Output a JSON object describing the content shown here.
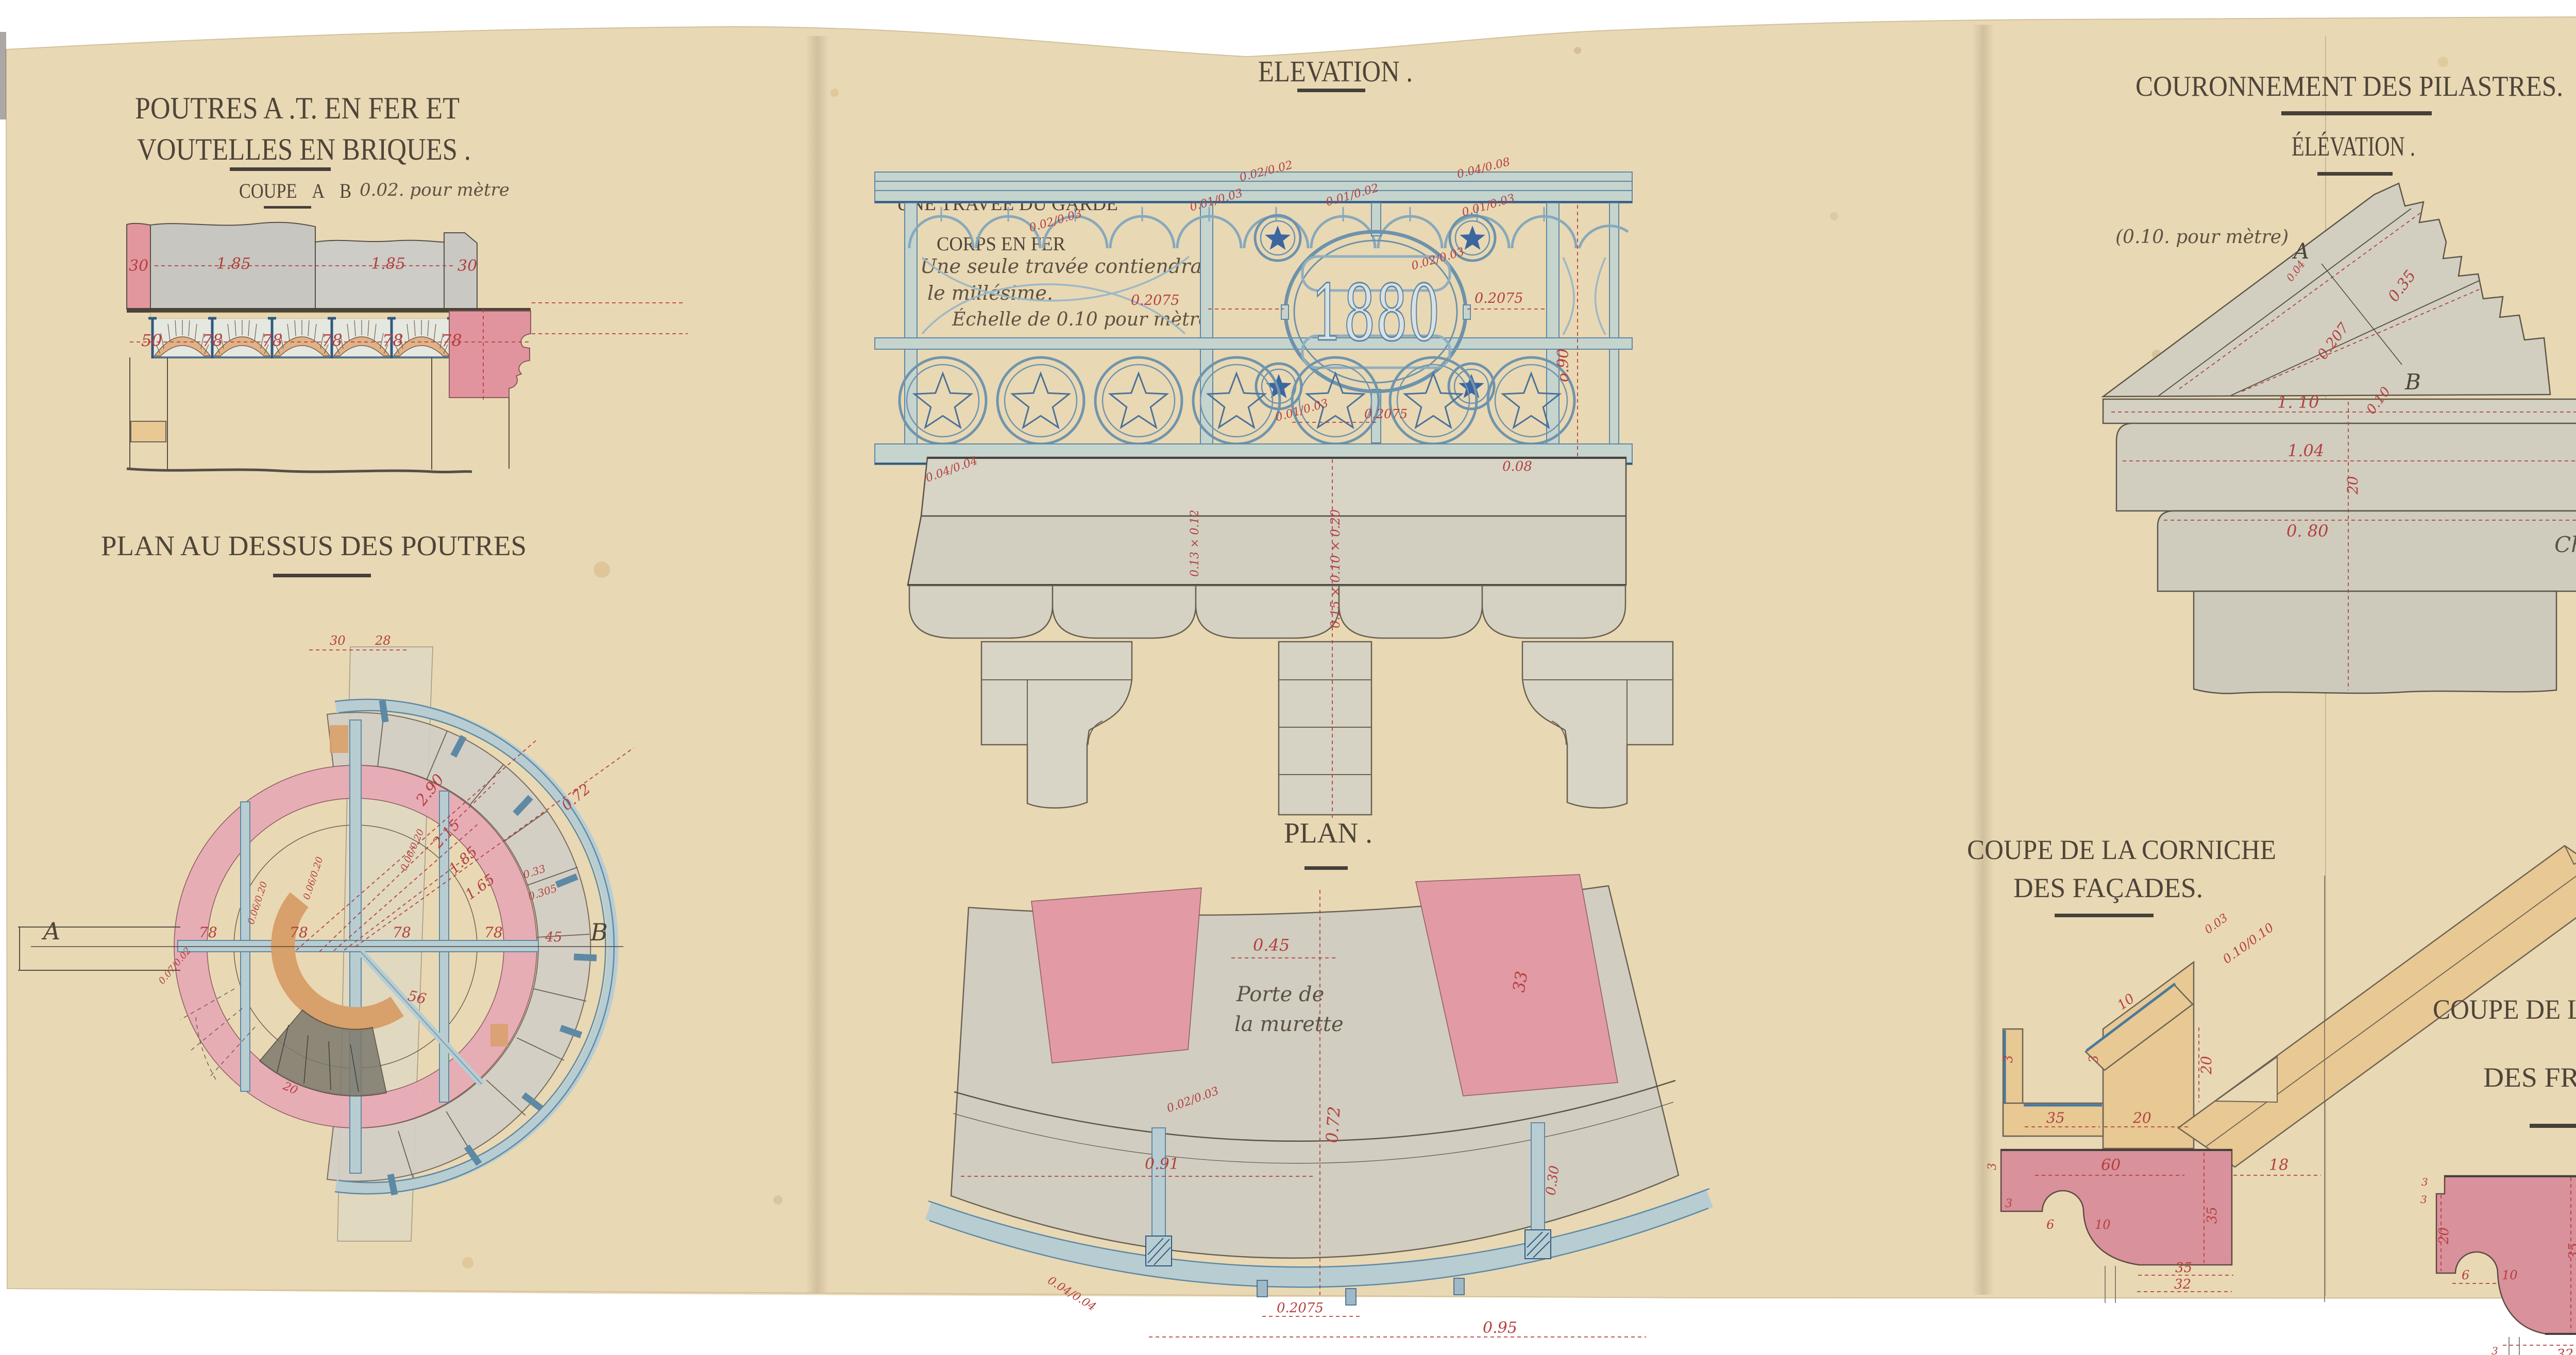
{
  "colors": {
    "paper": "#e9d8b4",
    "white_margin": "#ffffff",
    "ink": "#4e4539",
    "dimension_red": "#b4403f",
    "iron_blue": "#5e89a4",
    "iron_blue_fill": "#c6d4ce",
    "stone_grey": "#d1cec0",
    "wash_pink": "#d9919b",
    "ring_pink": "#e7abb5",
    "wood_yellow": "#e8c893",
    "brick_orange": "#e0b287",
    "star_blue": "#3c66a0"
  },
  "sections": {
    "poutres": {
      "title_line1": "POUTRES A .T. EN FER ET",
      "title_line2": "VOUTELLES EN BRIQUES .",
      "subtitle": "COUPE  A  B",
      "scale_note": "0.02. pour mètre",
      "dims": [
        "30",
        "1.85",
        "1.85",
        "30",
        "50",
        "78",
        "78",
        "78",
        "78",
        "78"
      ]
    },
    "plan_poutres": {
      "title": "PLAN AU DESSUS DES POUTRES",
      "axis_a": "A",
      "axis_b": "B",
      "dims": [
        "30",
        "28",
        "78",
        "78",
        "78",
        "78",
        "2.90",
        "2.15",
        "1.85",
        "1.65",
        "0.72",
        "56",
        "45",
        "20",
        "0.06/0.20",
        "0.06/0.20",
        "0.06/0.20",
        "0.33",
        "0.305",
        "0.07/0.02"
      ]
    },
    "garde_corps": {
      "title": "ELEVATION .",
      "label_line1": "UNE TRAVÉE DU GARDE",
      "label_line2": "CORPS EN FER",
      "note_line1": "Une seule travée contiendra",
      "note_line2": "le millésime.",
      "note_line3": "Échelle de 0.10 pour mètre",
      "medallion_year": "1880",
      "dims": [
        "0.02/0.02",
        "0.04/0.08",
        "0.02/0.03",
        "0.01/0.03",
        "0.01/0.02",
        "0.01/0.03",
        "0.2075",
        "0.2075",
        "0.02/0.03",
        "0.01/0.03",
        "0.2075",
        "o.90",
        "0.04/0.04",
        "0.08",
        "0.15 × 0.10 × 0.20",
        "0.13 × 0.12"
      ]
    },
    "balcon_plan": {
      "title": "PLAN .",
      "note_dim": "0.45",
      "note_line1": "Porte de",
      "note_line2": "la murette",
      "dims": [
        "33",
        "0.91",
        "0.72",
        "0.2075",
        "0.95",
        "0.30",
        "0.02/0.03",
        "0.04/0.04"
      ]
    },
    "couronnement": {
      "title": "COURONNEMENT DES PILASTRES.",
      "subtitle": "ÉLÉVATION .",
      "scale_note": "(0.10. pour mètre)",
      "label_a": "A",
      "label_b": "B",
      "dims": [
        "0.04",
        "0.35",
        "0.207",
        "0.10",
        "1. 10",
        "1.04",
        "20",
        "0. 80"
      ]
    },
    "corniche_facades": {
      "title_line1": "COUPE DE LA CORNICHE",
      "title_line2": "DES FAÇADES.",
      "dims": [
        "0.03",
        "0.10/0.10",
        "10",
        "3",
        "3",
        "35",
        "20",
        "20",
        "60",
        "18",
        "3",
        "3",
        "6",
        "10",
        "35",
        "35",
        "32"
      ]
    },
    "corniche_frontons": {
      "title_line1": "COUPE DE LA CORNICHE",
      "title_line2": "DES FRONTONS. A.B.",
      "dims": [
        "3",
        "3",
        "20",
        "6",
        "10",
        "35",
        "28",
        "32",
        "3"
      ]
    },
    "console": {
      "title": "UNE CONSOLE DU BALCON .",
      "subtitle": "COUPE .  A . B .",
      "scale_note": "(0.10. pour mètre)",
      "dims": [
        "1.10",
        "10",
        "5",
        "15",
        "5",
        "15",
        "15",
        "5",
        "5"
      ]
    },
    "chambranles": {
      "note_line1": "Chambranles des portes",
      "note_line2": "et fenêtres. 0.20. pour mètre",
      "door_label": "Porte",
      "dims": [
        "0.07",
        "0.16"
      ]
    },
    "pilastre_elevation": {
      "title": "ÉLÉVATION:.",
      "dims": [
        "155",
        "0.40",
        "155",
        "10",
        "5",
        "15",
        "15",
        "5"
      ]
    },
    "plan_superieur": {
      "title": "PLAN SUPÉRIEUR .",
      "dims": [
        "0. 52",
        "50"
      ]
    }
  }
}
